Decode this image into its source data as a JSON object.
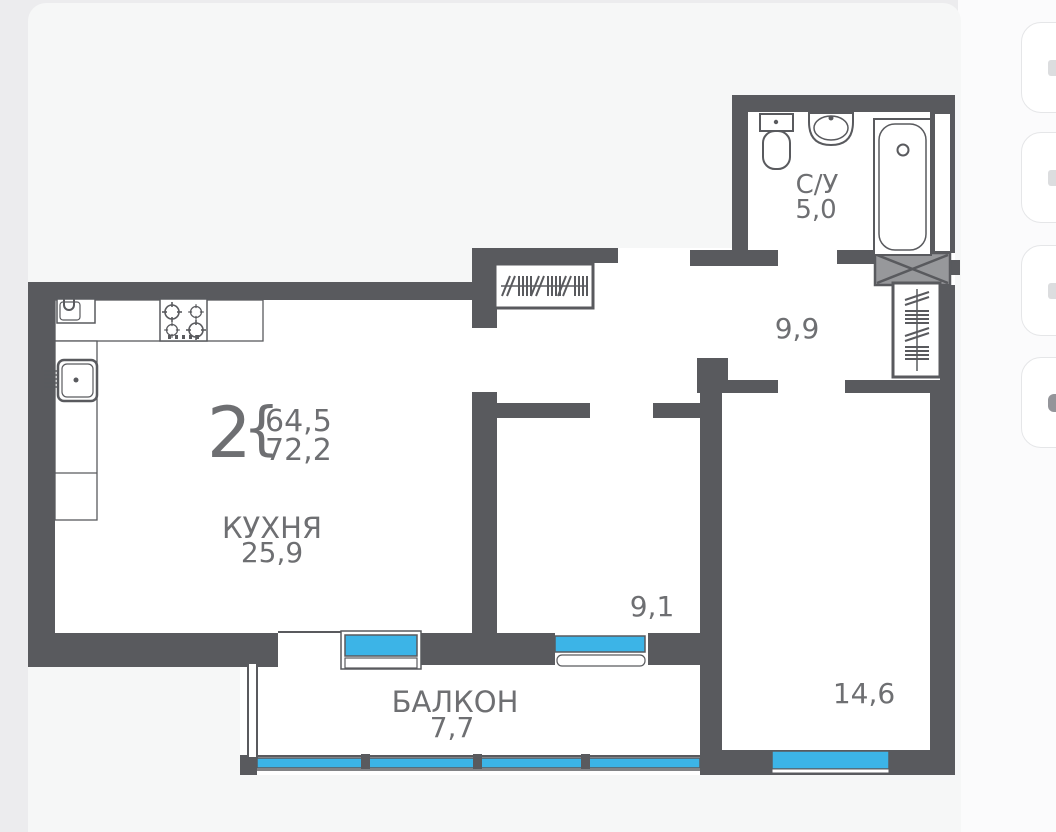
{
  "plan": {
    "summary": {
      "rooms_count": "2",
      "brace": "{",
      "area_living": "64,5",
      "area_total": "72,2"
    },
    "rooms": {
      "kitchen": {
        "label": "КУХНЯ",
        "area": "25,9"
      },
      "bathroom": {
        "label": "С/У",
        "area": "5,0"
      },
      "hallway": {
        "area": "9,9"
      },
      "bedroom": {
        "area": "9,1"
      },
      "living": {
        "area": "14,6"
      },
      "balcony": {
        "label": "БАЛКОН",
        "area": "7,7"
      }
    },
    "colors": {
      "wall": "#595a5e",
      "accent_blue": "#41b5e7",
      "window_cyan": "#3cb4e7",
      "label_gray": "#6e6f72",
      "card": "#f6f7f7",
      "background": "#ececee"
    }
  },
  "sidebar": {
    "buttons": [
      {
        "icon": "cropped-icon"
      },
      {
        "icon": "cropped-icon"
      },
      {
        "icon": "cropped-icon"
      },
      {
        "icon": "cropped-icon"
      }
    ]
  }
}
